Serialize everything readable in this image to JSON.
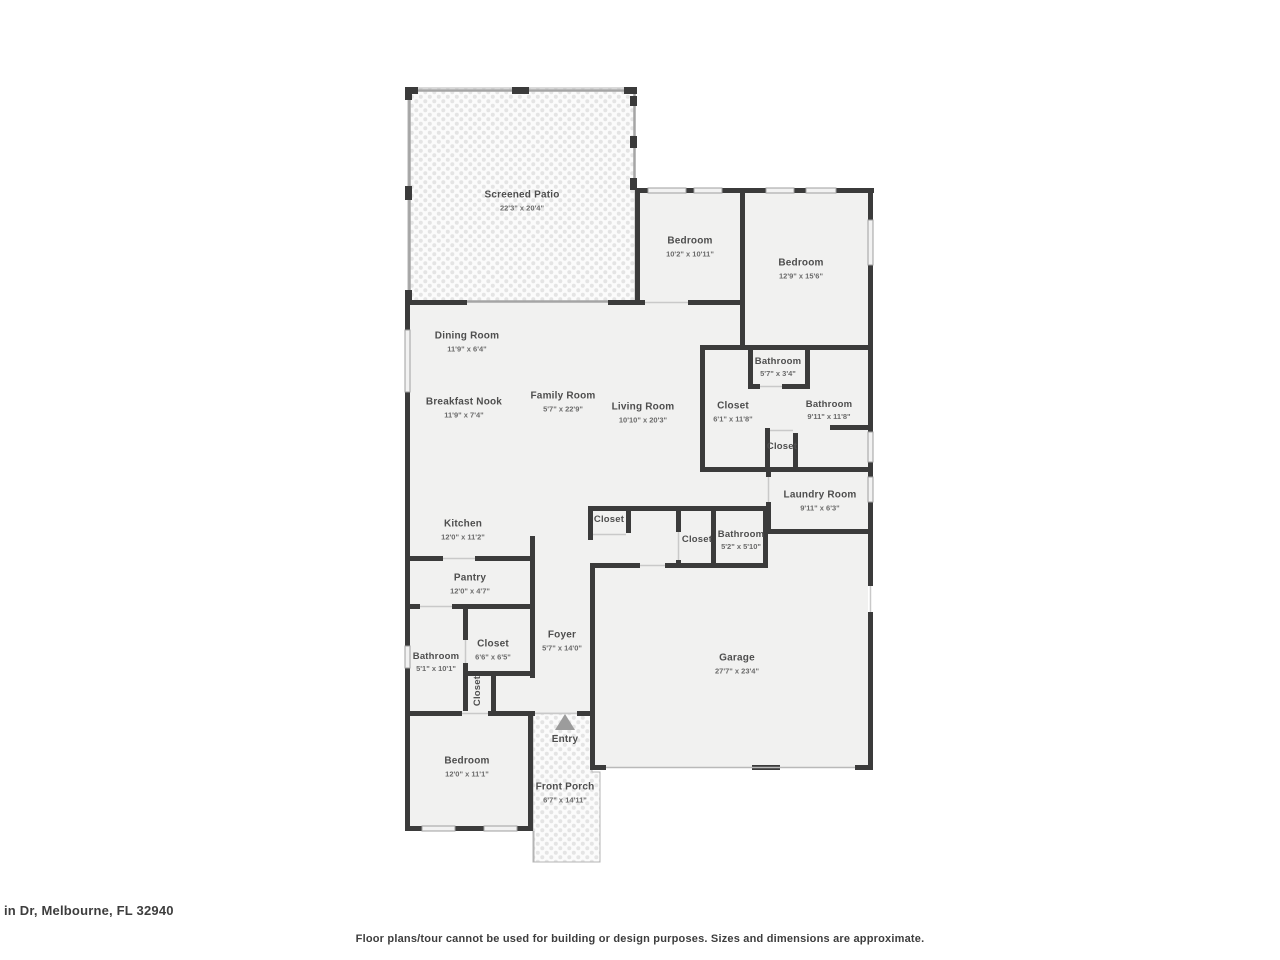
{
  "footer": {
    "address": "in Dr, Melbourne, FL 32940",
    "disclaimer": "Floor plans/tour cannot be used for building or design purposes. Sizes and dimensions are approximate."
  },
  "colors": {
    "wall": "#3b3b3b",
    "floor": "#f1f1f0",
    "patio_background": "#fbfbfb",
    "patio_dot": "#e4e4e4",
    "door_line": "#c9c9c9",
    "screen_line": "#a5a5a5",
    "window_fill": "#f2f2f2",
    "window_stroke": "#9f9f9f",
    "label_text": "#4e4e4e",
    "entry_arrow": "#9c9c9c"
  },
  "rooms": [
    {
      "name": "Screened Patio",
      "dims": "22'3\" x 20'4\""
    },
    {
      "name": "Bedroom",
      "dims": "10'2\" x 10'11\""
    },
    {
      "name": "Bedroom",
      "dims": "12'9\" x 15'6\""
    },
    {
      "name": "Dining Room",
      "dims": "11'9\" x 6'4\""
    },
    {
      "name": "Breakfast Nook",
      "dims": "11'9\" x 7'4\""
    },
    {
      "name": "Family Room",
      "dims": "5'7\" x 22'9\""
    },
    {
      "name": "Living Room",
      "dims": "10'10\" x 20'3\""
    },
    {
      "name": "Bathroom",
      "dims": "5'7\" x 3'4\""
    },
    {
      "name": "Closet",
      "dims": "6'1\" x 11'8\""
    },
    {
      "name": "Bathroom",
      "dims": "9'11\" x 11'8\""
    },
    {
      "name": "Closet",
      "dims": ""
    },
    {
      "name": "Laundry Room",
      "dims": "9'11\" x 6'3\""
    },
    {
      "name": "Kitchen",
      "dims": "12'0\" x 11'2\""
    },
    {
      "name": "Closet",
      "dims": ""
    },
    {
      "name": "Closet",
      "dims": ""
    },
    {
      "name": "Bathroom",
      "dims": "5'2\" x 5'10\""
    },
    {
      "name": "Pantry",
      "dims": "12'0\" x 4'7\""
    },
    {
      "name": "Bathroom",
      "dims": "5'1\" x 10'1\""
    },
    {
      "name": "Closet",
      "dims": "6'6\" x 6'5\""
    },
    {
      "name": "Closet",
      "dims": ""
    },
    {
      "name": "Foyer",
      "dims": "5'7\" x 14'0\""
    },
    {
      "name": "Garage",
      "dims": "27'7\" x 23'4\""
    },
    {
      "name": "Bedroom",
      "dims": "12'0\" x 11'1\""
    },
    {
      "name": "Entry",
      "dims": ""
    },
    {
      "name": "Front Porch",
      "dims": "6'7\" x 14'11\""
    }
  ]
}
